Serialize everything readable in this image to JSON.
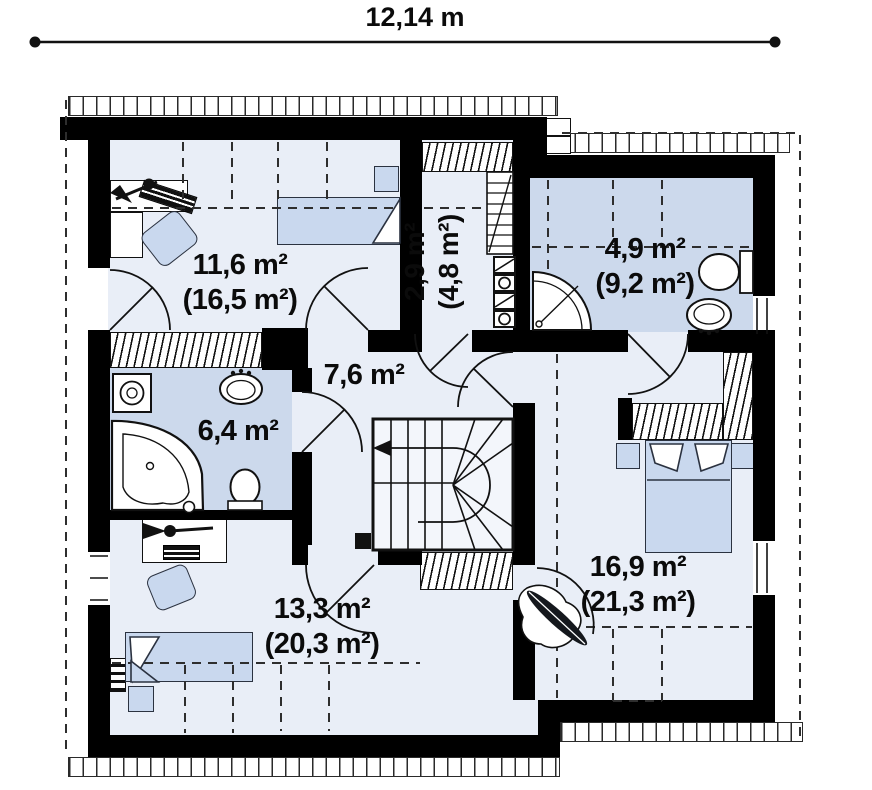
{
  "dimension": {
    "width_label": "12,14 m"
  },
  "rooms": [
    {
      "name": "bedroom-top-left",
      "area": "11,6 m²",
      "gross_area": "(16,5 m²)"
    },
    {
      "name": "corridor",
      "area": "2,9 m²",
      "gross_area": "(4,8 m²)"
    },
    {
      "name": "bathroom-top-right",
      "area": "4,9 m²",
      "gross_area": "(9,2 m²)"
    },
    {
      "name": "hall-landing",
      "area": "7,6 m²",
      "gross_area": ""
    },
    {
      "name": "bathroom-left",
      "area": "6,4 m²",
      "gross_area": ""
    },
    {
      "name": "bedroom-bottom-left",
      "area": "13,3 m²",
      "gross_area": "(20,3 m²)"
    },
    {
      "name": "bedroom-bottom-right",
      "area": "16,9 m²",
      "gross_area": "(21,3 m²)"
    }
  ],
  "colors": {
    "wall": "#000000",
    "room_fill": "#e9eef7",
    "wet_room_fill": "#ccd9ec",
    "furniture_fill": "#c9d8ee",
    "line": "#111111"
  }
}
